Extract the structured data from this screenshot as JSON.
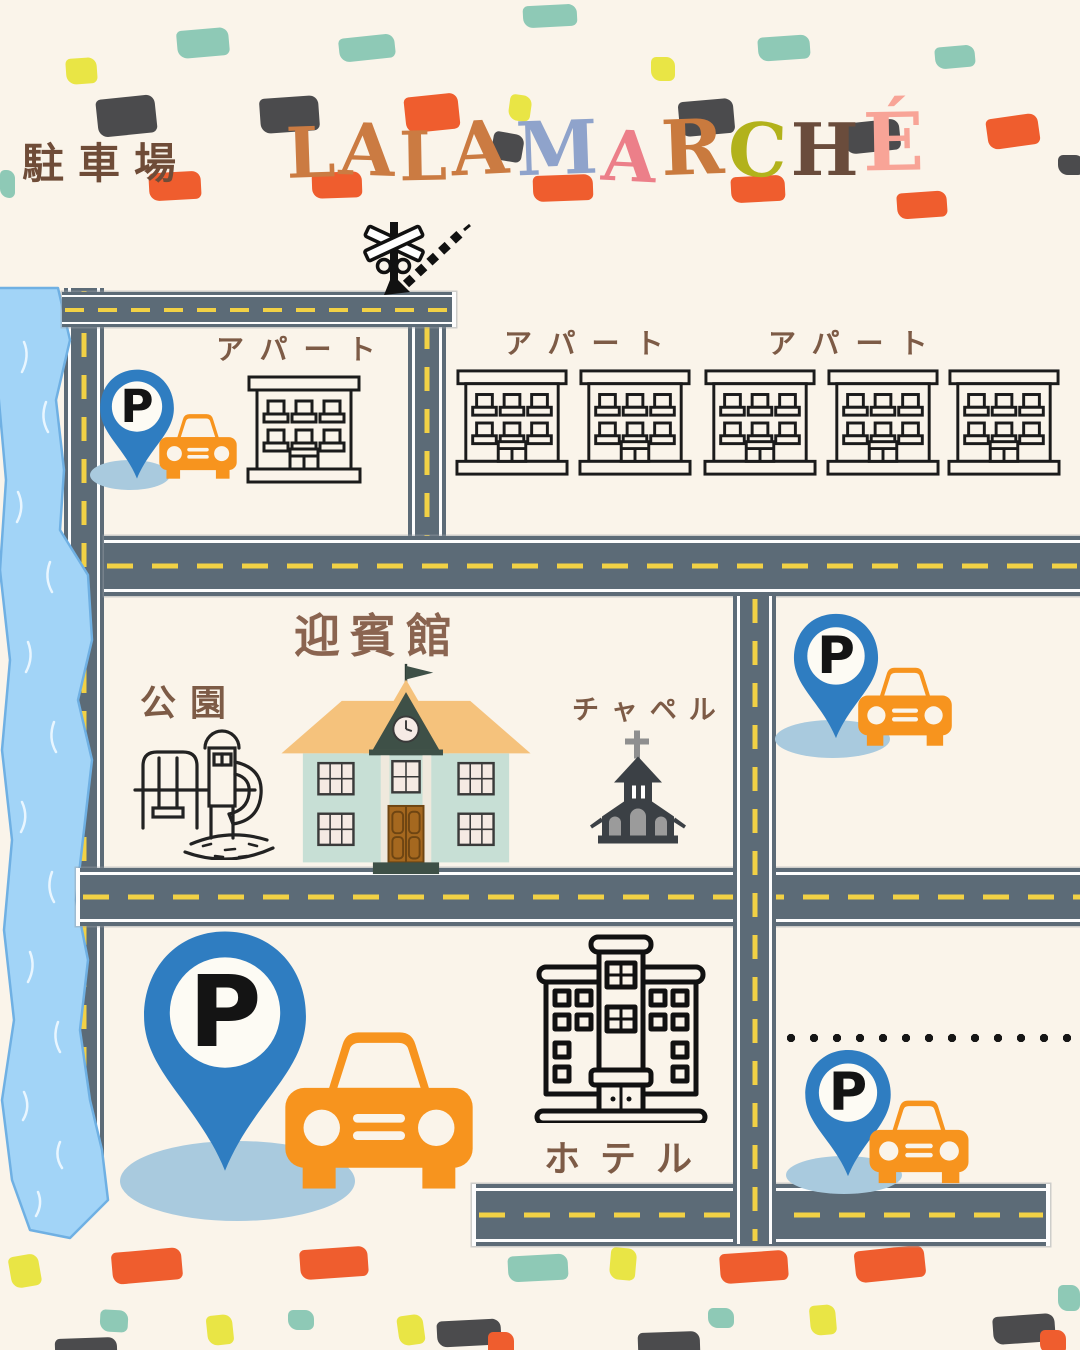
{
  "page": {
    "width": 1080,
    "height": 1350,
    "background": "#faf4ea"
  },
  "header": {
    "area_label": "駐車場",
    "brand": "LALA MARCHÉ",
    "brand_letters": [
      {
        "char": "L",
        "color": "#cb7b42"
      },
      {
        "char": "A",
        "color": "#cb7b42"
      },
      {
        "char": "L",
        "color": "#cb7b42"
      },
      {
        "char": "A",
        "color": "#cb7b42"
      },
      {
        "char": " ",
        "color": ""
      },
      {
        "char": "M",
        "color": "#8fa3cb"
      },
      {
        "char": "A",
        "color": "#ec7f89"
      },
      {
        "char": "R",
        "color": "#c97a3e"
      },
      {
        "char": "C",
        "color": "#b2b21b"
      },
      {
        "char": "H",
        "color": "#6a4c3c"
      },
      {
        "char": "É",
        "color": "#f8a497"
      }
    ]
  },
  "labels": {
    "apartment": "アパート",
    "guest_house": "迎賓館",
    "park": "公園",
    "chapel": "チャペル",
    "hotel": "ホテル",
    "parking_symbol": "P"
  },
  "palette": {
    "road": "#5c6b77",
    "road_dash": "#f2d145",
    "road_edge": "#fdfdfd",
    "river": "#a2d4f7",
    "river_edge": "#6fb0e3",
    "pin_blue": "#2f7dc1",
    "car_orange": "#f7941e",
    "shadow_blue": "#a9cade",
    "label_brown": "#7d5b46",
    "dark_label_brown": "#6f4c38",
    "building_ink": "#1b1b1b",
    "chapel_dark": "#3b4045",
    "guesthouse_wall": "#c7dfd5",
    "guesthouse_roof": "#f5c27c",
    "guesthouse_trim": "#3e5047",
    "guesthouse_door": "#a5681f",
    "confetti_gray": "#4b4b4d",
    "confetti_orange": "#ef5d2e",
    "confetti_teal": "#8ec9b6",
    "confetti_yellow": "#e9e545"
  }
}
